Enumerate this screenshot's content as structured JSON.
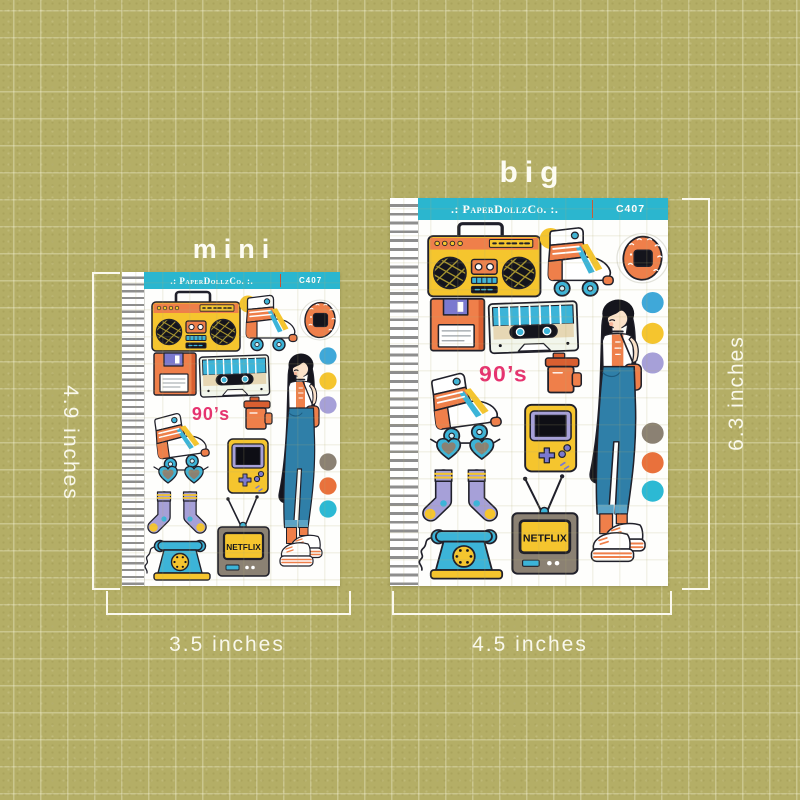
{
  "page": {
    "background_color": "#b4ae66",
    "grid_color": "#c7c17b"
  },
  "labels": {
    "mini": "mini",
    "big": "big",
    "mini_height": "4.9 inches",
    "mini_width": "3.5 inches",
    "big_height": "6.3 inches",
    "big_width": "4.5 inches"
  },
  "sheet": {
    "brand": ".: PaperDollzCo. :.",
    "code": "C407",
    "header_color": "#2bb6cf"
  },
  "stickers": {
    "nineties_text": "90’s",
    "tv_text": "NETFLIX",
    "items": [
      "boombox",
      "roller-skate",
      "tamagotchi",
      "floppy-disk",
      "cassette-tape",
      "90s-text",
      "film-canister",
      "girl-with-black-hair",
      "game-boy",
      "heart-sunglasses",
      "roller-skate",
      "striped-socks",
      "netflix-tv",
      "rotary-phone",
      "color-dots"
    ],
    "dot_colors": [
      "#3fa8d9",
      "#f5c52e",
      "#a6a0d8",
      "#8b8173",
      "#e9713c",
      "#2cb9d4"
    ]
  }
}
